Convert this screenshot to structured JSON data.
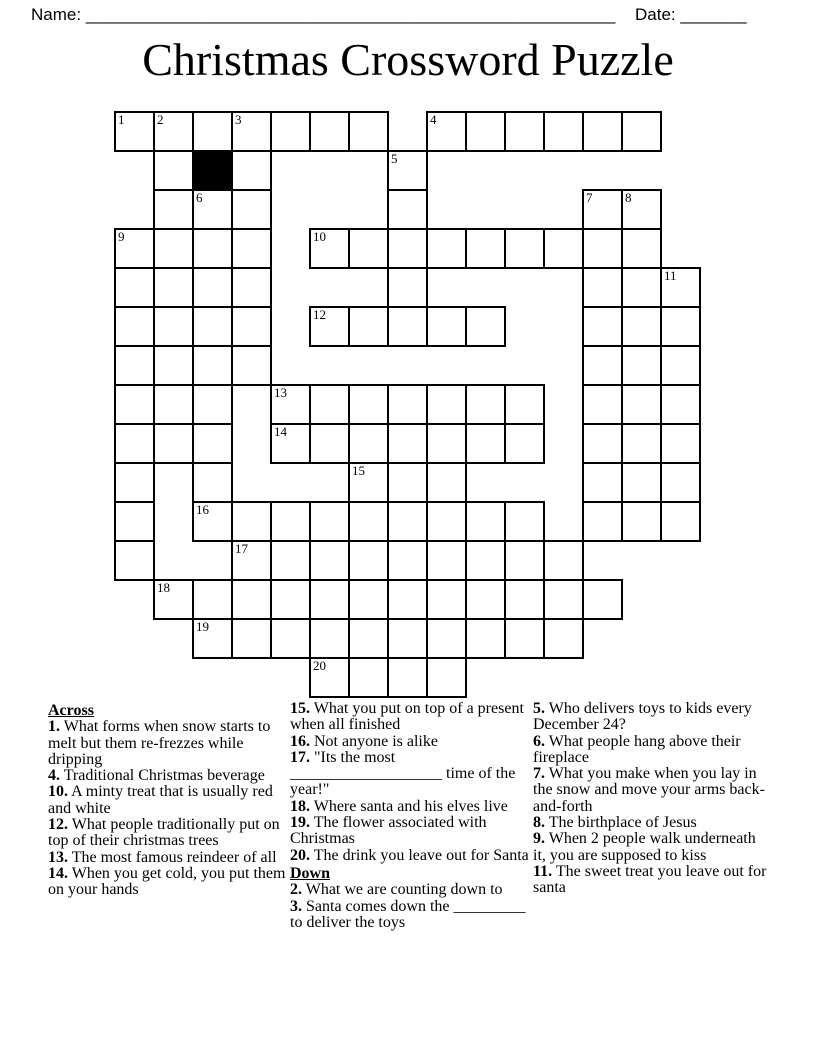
{
  "page": {
    "name_label": "Name:",
    "name_line": "________________________________________________________",
    "date_label": "Date:",
    "date_line": "_______",
    "title": "Christmas Crossword Puzzle"
  },
  "grid": {
    "rows": 15,
    "cols": 15,
    "cell_size": 39,
    "origin_x": 115,
    "origin_y": 112,
    "line_color": "#000000",
    "black_cell_color": "#000000",
    "pattern": [
      "OOOOOOO.OOOOOO.",
      ".O#O...O.......",
      ".OOO...O....OO.",
      "OOOO.OOOOOOOOO.",
      "OOOO...O....OOO",
      "OOOO.OOOOO..OOO",
      "OOOO........OOO",
      "OOO.OOOOOOO.OOO",
      "OOO.OOOOOOO.OOO",
      "O.O...OOO...OOO",
      "O.OOOOOOOOO.OOO",
      "O..OOOOOOOOO...",
      ".OOOOOOOOOOOO..",
      "..OOOOOOOOOO...",
      ".....OOOO......"
    ],
    "numbers": {
      "1": [
        0,
        0
      ],
      "2": [
        0,
        1
      ],
      "3": [
        0,
        3
      ],
      "4": [
        0,
        8
      ],
      "5": [
        1,
        7
      ],
      "6": [
        2,
        2
      ],
      "7": [
        2,
        12
      ],
      "8": [
        2,
        13
      ],
      "9": [
        3,
        0
      ],
      "10": [
        3,
        5
      ],
      "11": [
        4,
        14
      ],
      "12": [
        5,
        5
      ],
      "13": [
        7,
        4
      ],
      "14": [
        8,
        4
      ],
      "15": [
        9,
        6
      ],
      "16": [
        10,
        2
      ],
      "17": [
        11,
        3
      ],
      "18": [
        12,
        1
      ],
      "19": [
        13,
        2
      ],
      "20": [
        14,
        5
      ]
    }
  },
  "clues": {
    "across_label": "Across",
    "down_label": "Down",
    "across": [
      {
        "num": "1",
        "text": "What forms when snow starts to melt but them re-frezzes while dripping"
      },
      {
        "num": "4",
        "text": "Traditional Christmas beverage"
      },
      {
        "num": "10",
        "text": "A minty treat that is usually red and white"
      },
      {
        "num": "12",
        "text": "What people traditionally put on top of their christmas trees"
      },
      {
        "num": "13",
        "text": "The most famous reindeer of all"
      },
      {
        "num": "14",
        "text": "When you get cold, you put them on your hands"
      },
      {
        "num": "15",
        "text": "What you put on top of a present when all finished"
      },
      {
        "num": "16",
        "text": "Not anyone is alike"
      },
      {
        "num": "17",
        "text": "\"Its the most ___________________ time of the year!\""
      },
      {
        "num": "18",
        "text": "Where santa and his elves live"
      },
      {
        "num": "19",
        "text": "The flower associated with Christmas"
      },
      {
        "num": "20",
        "text": "The drink you leave out for Santa"
      }
    ],
    "down": [
      {
        "num": "2",
        "text": "What we are counting down to"
      },
      {
        "num": "3",
        "text": "Santa comes down the _________ to deliver the toys"
      },
      {
        "num": "5",
        "text": "Who delivers toys to kids every December 24?"
      },
      {
        "num": "6",
        "text": "What people hang above their fireplace"
      },
      {
        "num": "7",
        "text": "What you make when you lay in the snow and move your arms back-and-forth"
      },
      {
        "num": "8",
        "text": "The birthplace of Jesus"
      },
      {
        "num": "9",
        "text": "When 2 people walk underneath it, you are supposed to kiss"
      },
      {
        "num": "11",
        "text": "The sweet treat you leave out for santa"
      }
    ]
  }
}
